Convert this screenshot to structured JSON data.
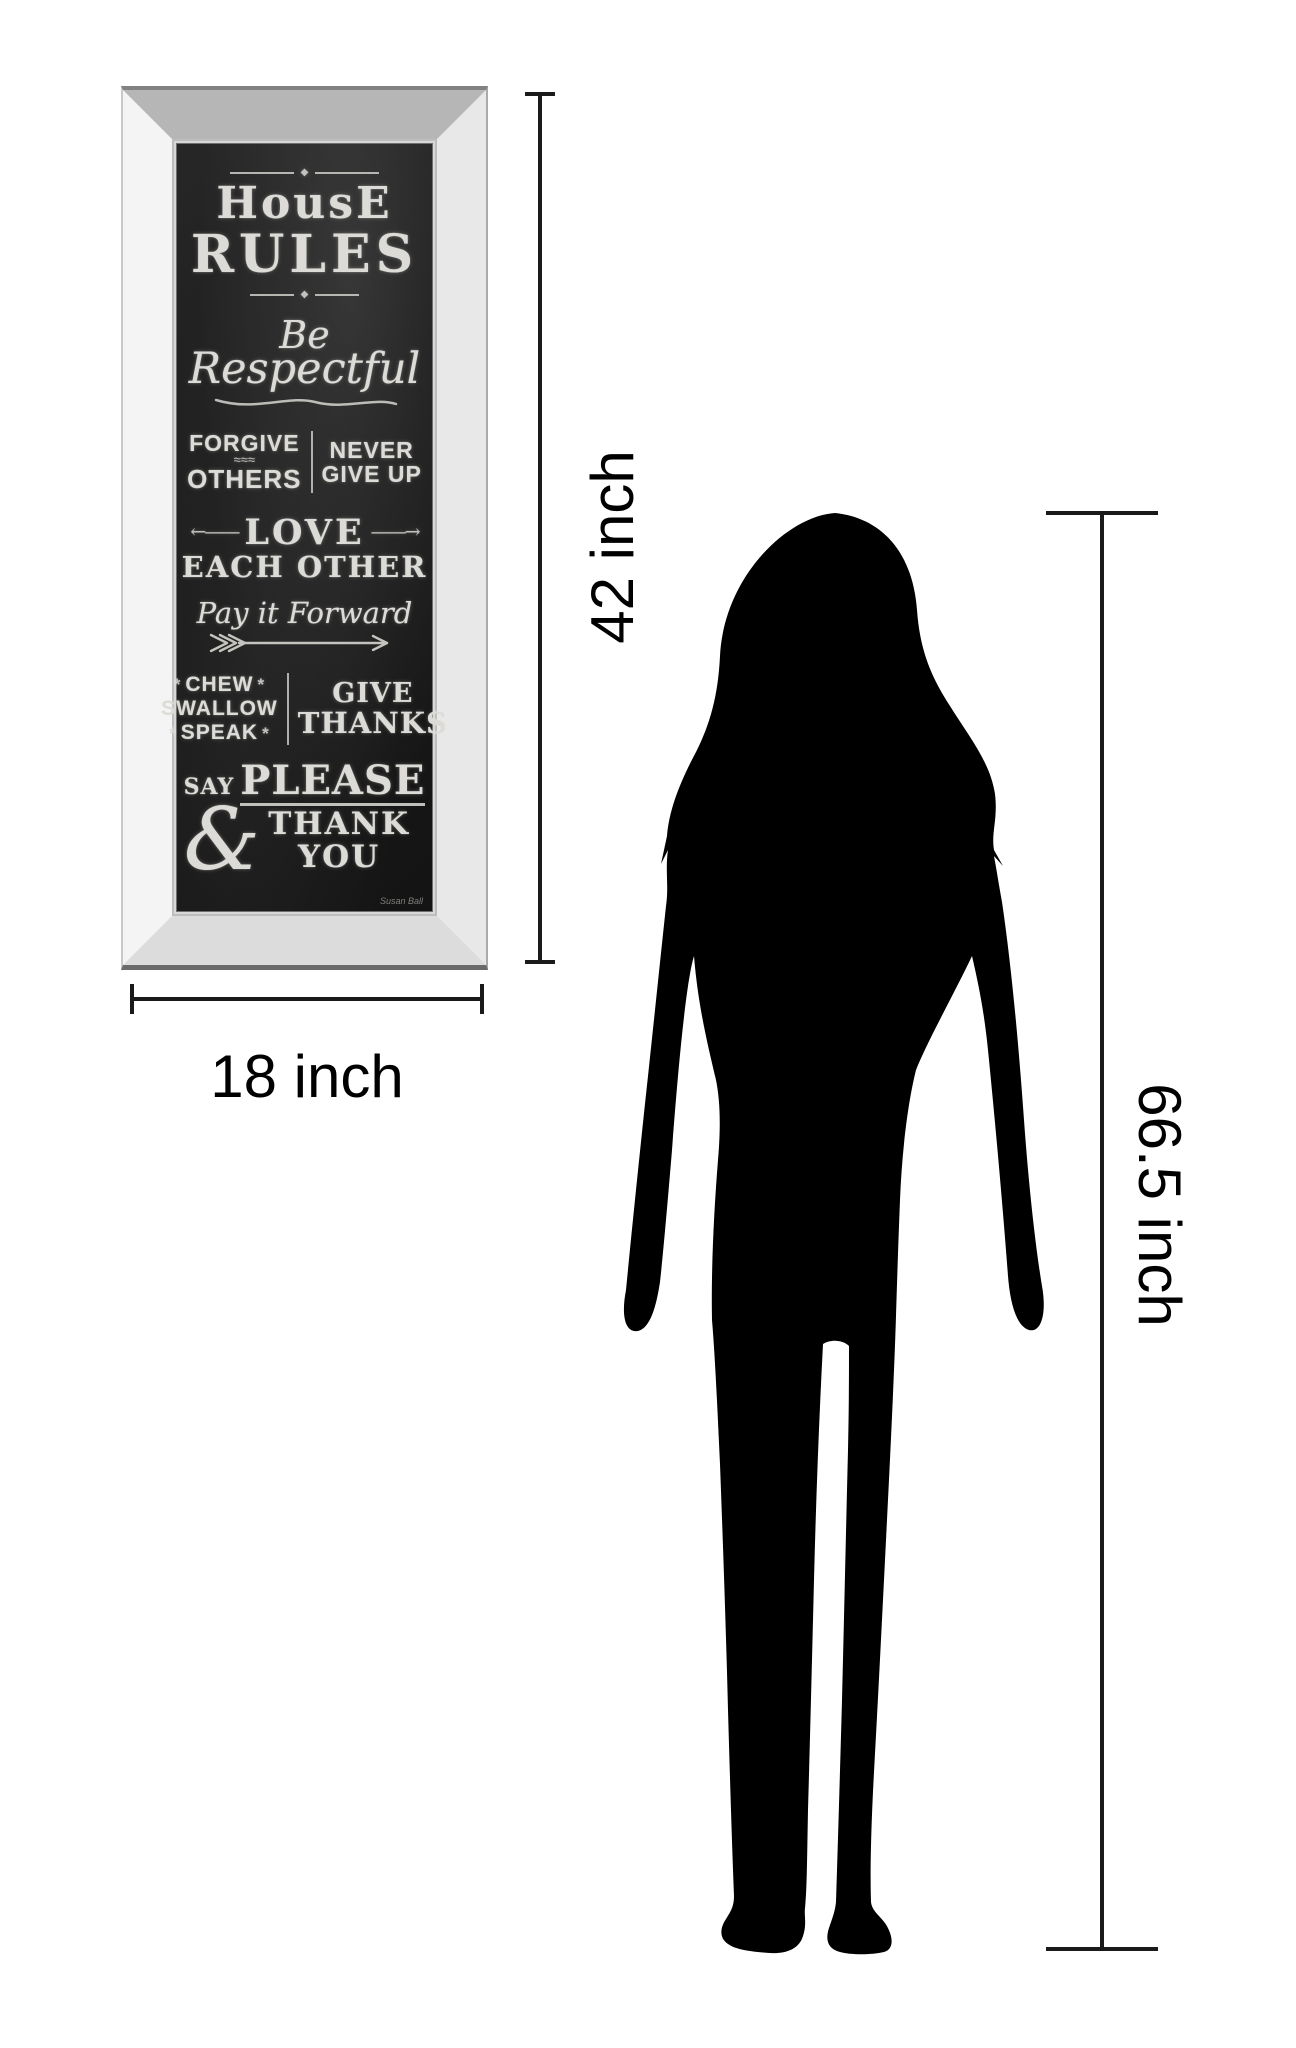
{
  "artwork": {
    "board_color": "#1d1d1d",
    "chalk_color": "#dcdbd7",
    "ornament_diamond": "◆",
    "title": {
      "line1": "HousE",
      "line2": "RULES"
    },
    "rule_respect": {
      "word1": "Be",
      "word2": "Respectful"
    },
    "rule_forgive": {
      "line1": "FORGIVE",
      "squiggle": "≈≈≈",
      "line2": "OTHERS"
    },
    "rule_never": {
      "line1": "NEVER",
      "line2": "GIVE UP"
    },
    "rule_love": {
      "arrow_left": "←——",
      "line1": "LOVE",
      "line2": "EACH OTHER",
      "arrow_right": "——→"
    },
    "rule_pay": {
      "text": "Pay it Forward"
    },
    "rule_chew": {
      "sparkle": "*",
      "line1": "CHEW",
      "line2": "SWALLOW",
      "line3": "SPEAK"
    },
    "rule_thanks": {
      "line1": "GIVE",
      "line2": "THANKS"
    },
    "rule_please": {
      "say": "SAY",
      "ampersand": "&",
      "please": "PLEASE",
      "thank": "THANK",
      "you": "YOU"
    },
    "signature": "Susan Ball"
  },
  "dimensions": {
    "art_height_label": "42 inch",
    "art_width_label": "18 inch",
    "person_height_label": "66.5 inch",
    "line_color": "#1a1a1a",
    "silhouette_color": "#000000"
  }
}
